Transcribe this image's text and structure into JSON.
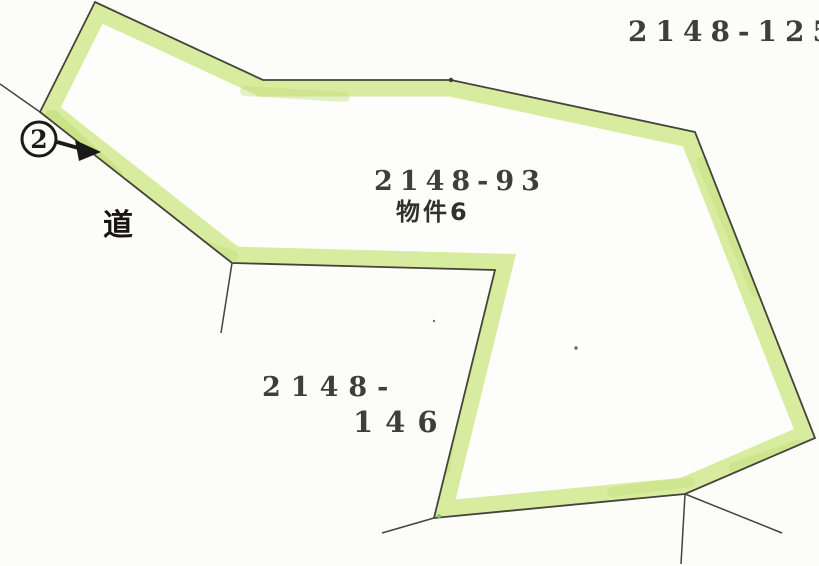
{
  "document": {
    "type": "cadastral-parcel-map",
    "labels": {
      "parcel_ne": "2148-125",
      "parcel_main": "2148-93",
      "parcel_main_note": "物件6",
      "parcel_sw_line1": "2148-",
      "parcel_sw_line2": "146",
      "road": "道",
      "marker_number": "2"
    },
    "colors": {
      "highlight": "#d7ec9e",
      "highlight_dark": "#bedd73",
      "boundary": "#45433a",
      "ink": "#1b1a16",
      "paper": "#fcfcf9"
    }
  }
}
